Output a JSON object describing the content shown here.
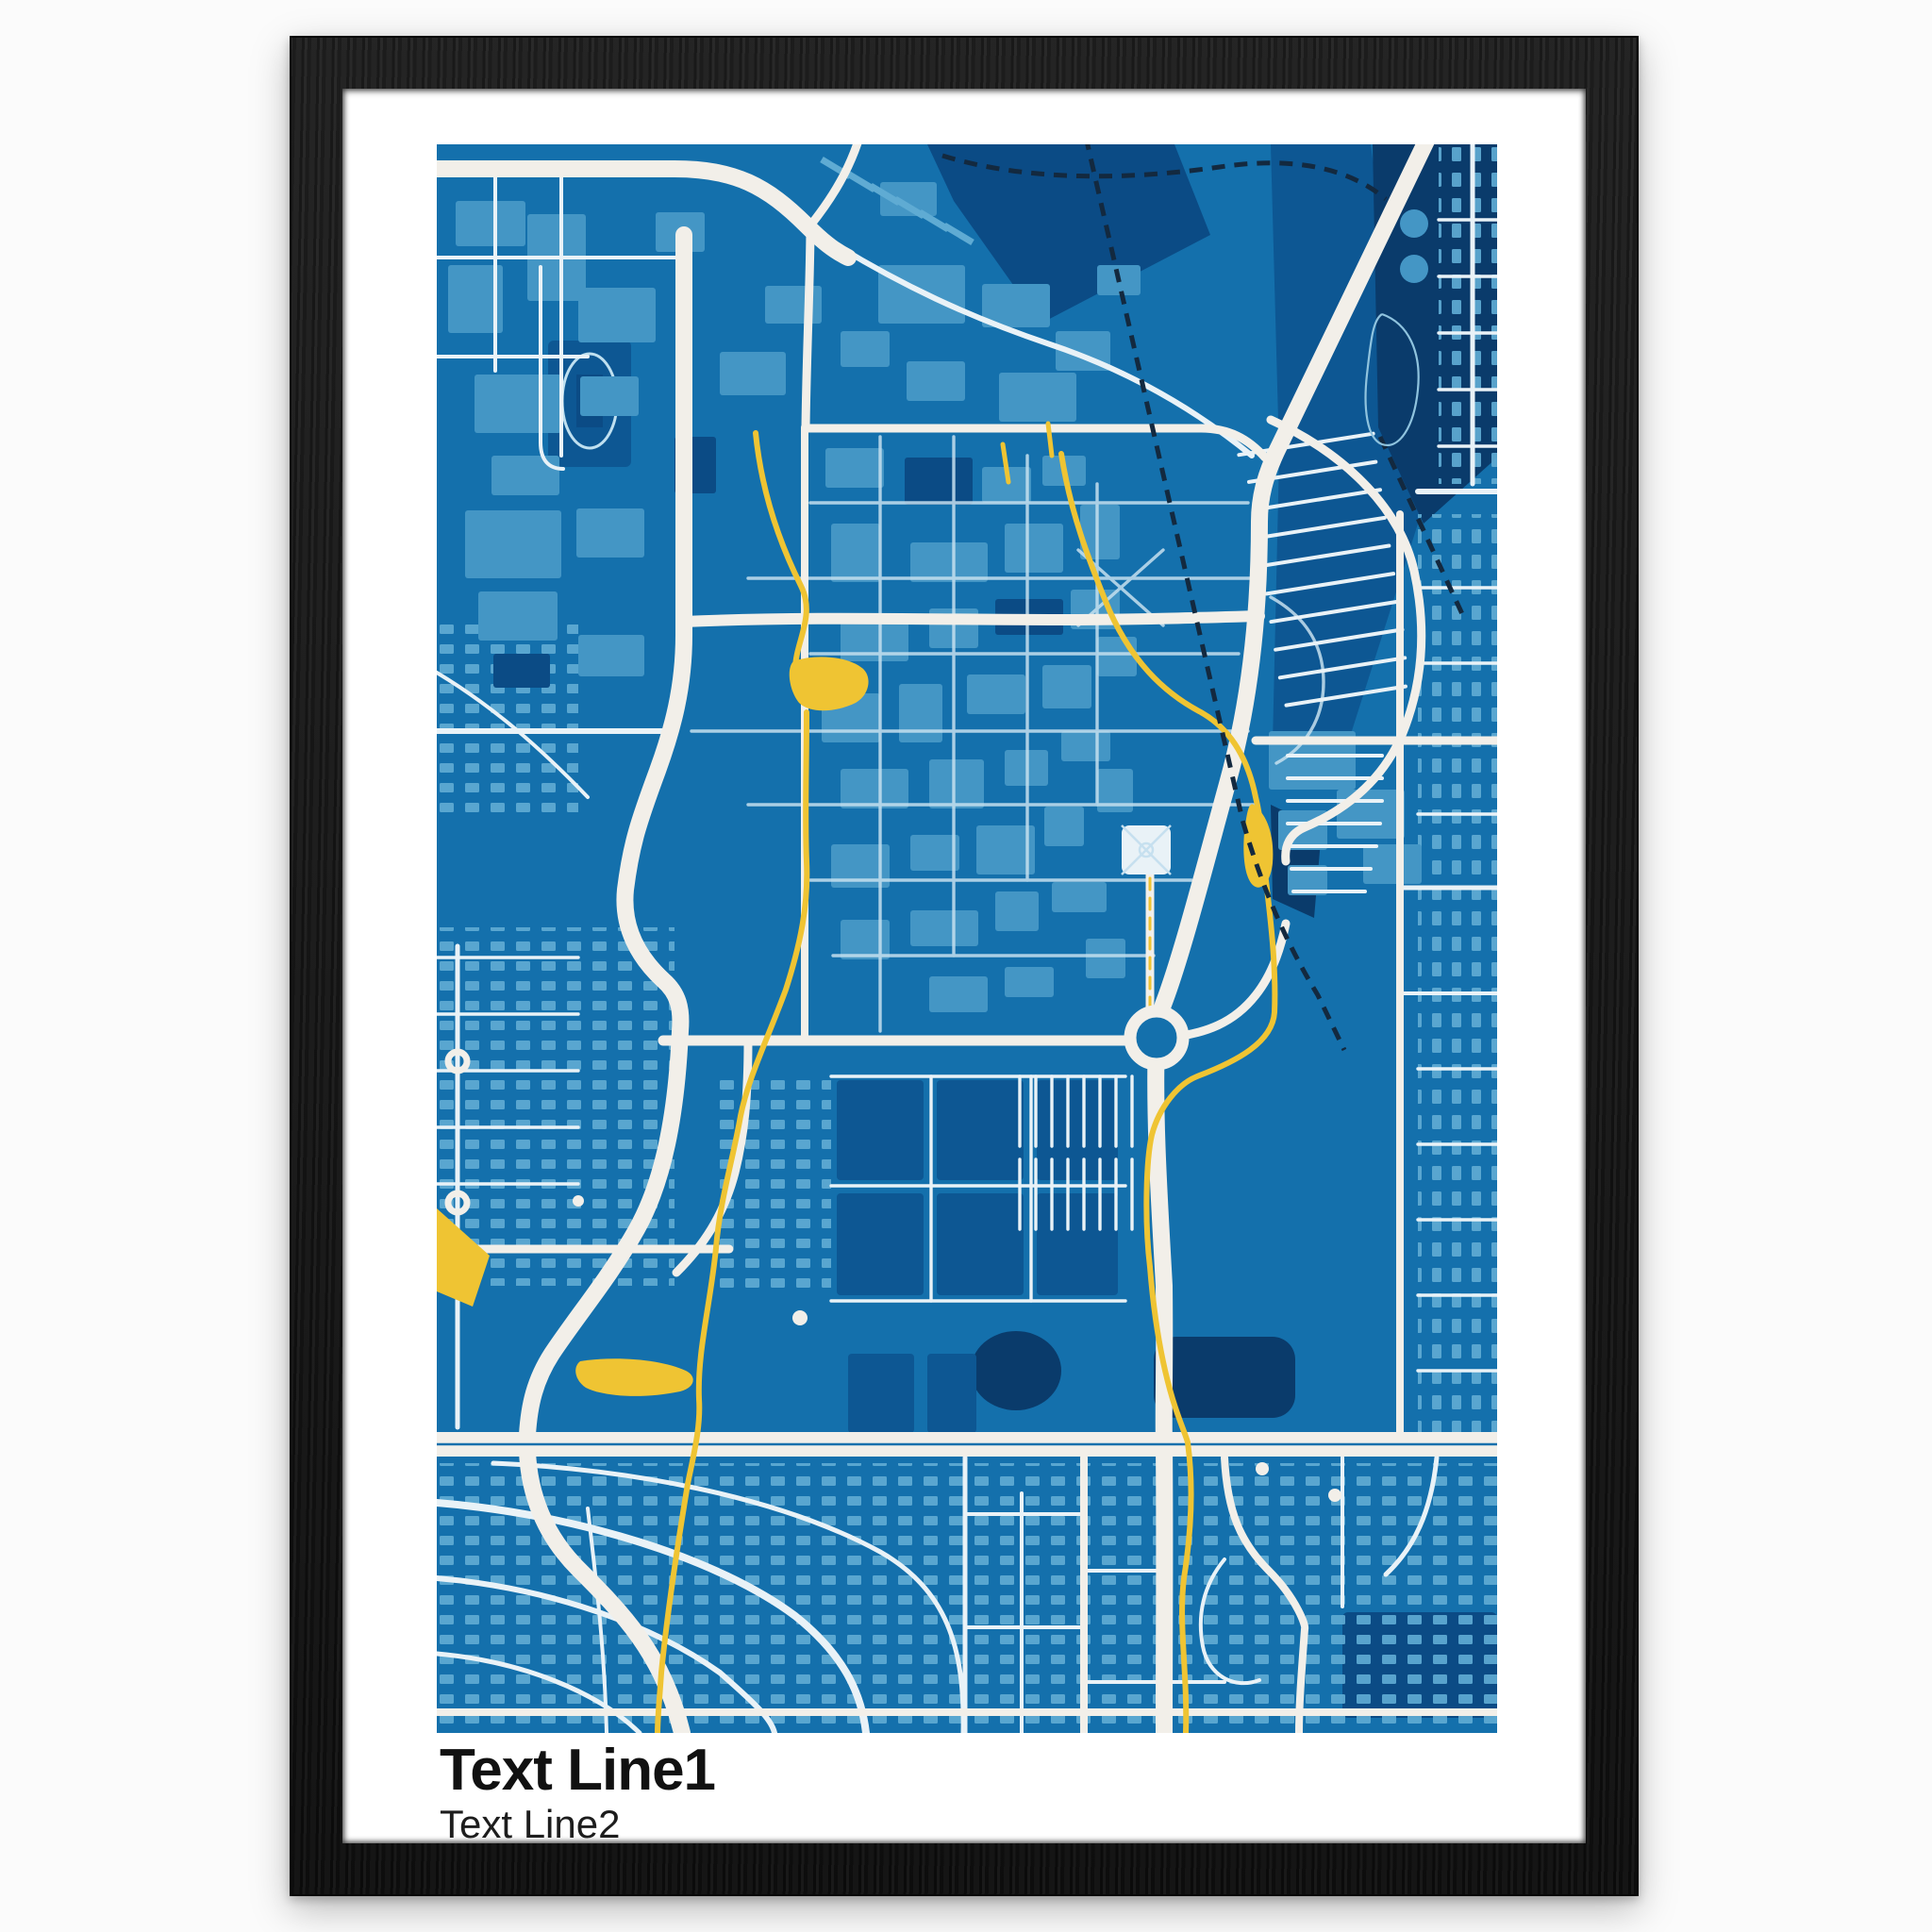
{
  "poster": {
    "text_line1": "Text Line1",
    "text_line2": "Text Line2",
    "artwork_kind": "blueprint-style city street map, no labels"
  },
  "frame": {
    "material": "black wood grain",
    "mat": "white"
  },
  "colors": {
    "page": "#fbfbfb",
    "frame": "#161616",
    "mat": "#ffffff",
    "map-bg": "#1470ac",
    "bldg": "#4496c5",
    "bldg2": "#5fabd3",
    "dark1": "#0d5793",
    "dark2": "#0b4b85",
    "navy": "#0a3b6b",
    "road": "#f2efe9",
    "road2": "#e9f2f7",
    "path": "#c6e0ef",
    "creek": "#efc433",
    "rail": "#13293f",
    "ink": "#111111",
    "ink2": "#1d1d1d"
  }
}
